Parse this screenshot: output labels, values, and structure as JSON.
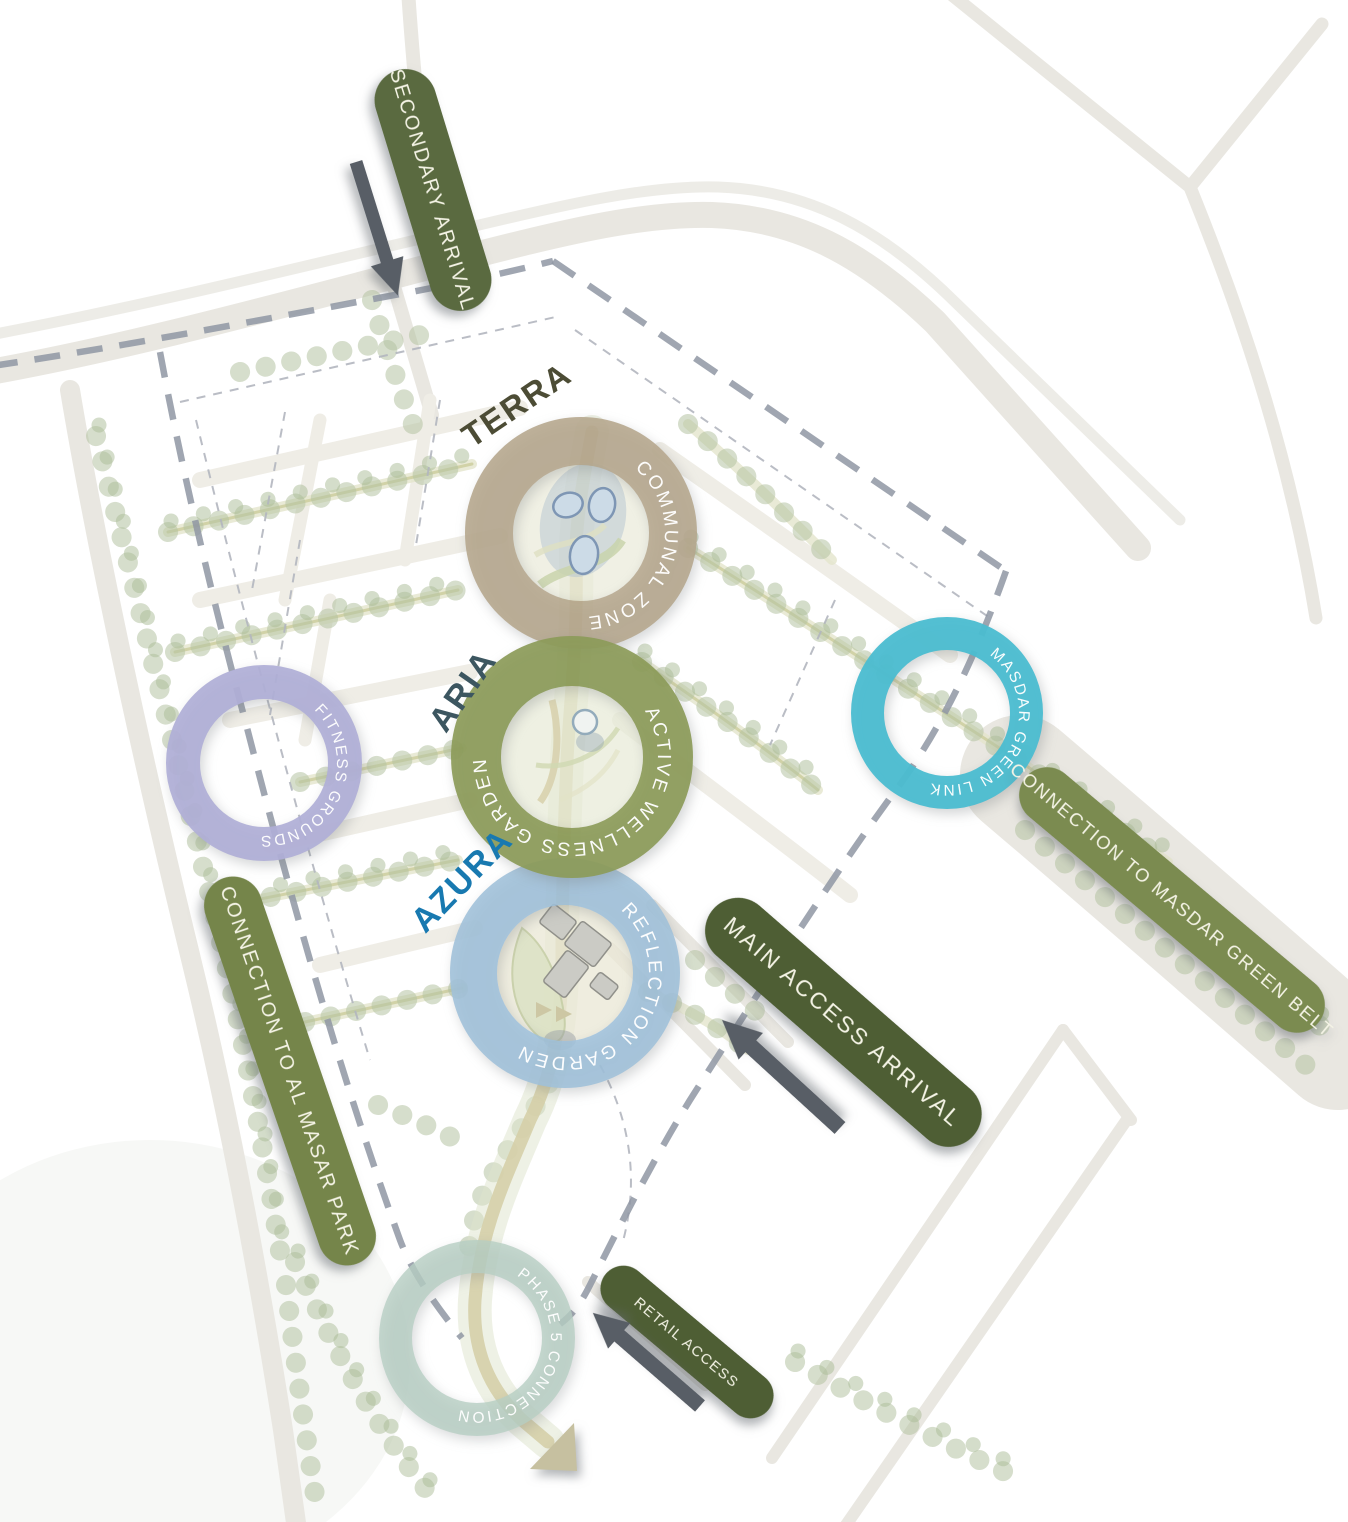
{
  "diagram": {
    "zones": {
      "terra": {
        "name": "TERRA",
        "feature": "COMMUNAL ZONE",
        "ring_color": "#b5a68c",
        "name_color": "#4c4c35"
      },
      "aria": {
        "name": "ARIA",
        "feature": "ACTIVE WELLNESS GARDEN",
        "ring_color": "#8c9b59",
        "name_color": "#3c5660"
      },
      "azura": {
        "name": "AZURA",
        "feature": "REFLECTION GARDEN",
        "ring_color": "#9fc0da",
        "name_color": "#1879b0"
      },
      "fitness": {
        "feature": "FITNESS GROUNDS",
        "ring_color": "#b0afd7"
      },
      "masdar_link": {
        "feature": "MASDAR GREEN LINK",
        "ring_color": "#4bbdd1"
      },
      "phase5": {
        "feature": "PHASE 5 CONNECTION",
        "ring_color": "#b7cec3"
      }
    },
    "callouts": {
      "secondary_arrival": {
        "label": "SECONDARY ARRIVAL",
        "color": "#5a6a40"
      },
      "main_access": {
        "label": "MAIN ACCESS ARRIVAL",
        "color": "#4e5e34"
      },
      "retail_access": {
        "label": "RETAIL ACCESS",
        "color": "#4e5e34"
      },
      "connection_masdar": {
        "label": "CONNECTION TO MASDAR GREEN BELT",
        "color": "#7b8b50"
      },
      "connection_almasar": {
        "label": "CONNECTION TO AL MASAR PARK",
        "color": "#75854a"
      }
    },
    "label_text_color": "#ffffff"
  }
}
